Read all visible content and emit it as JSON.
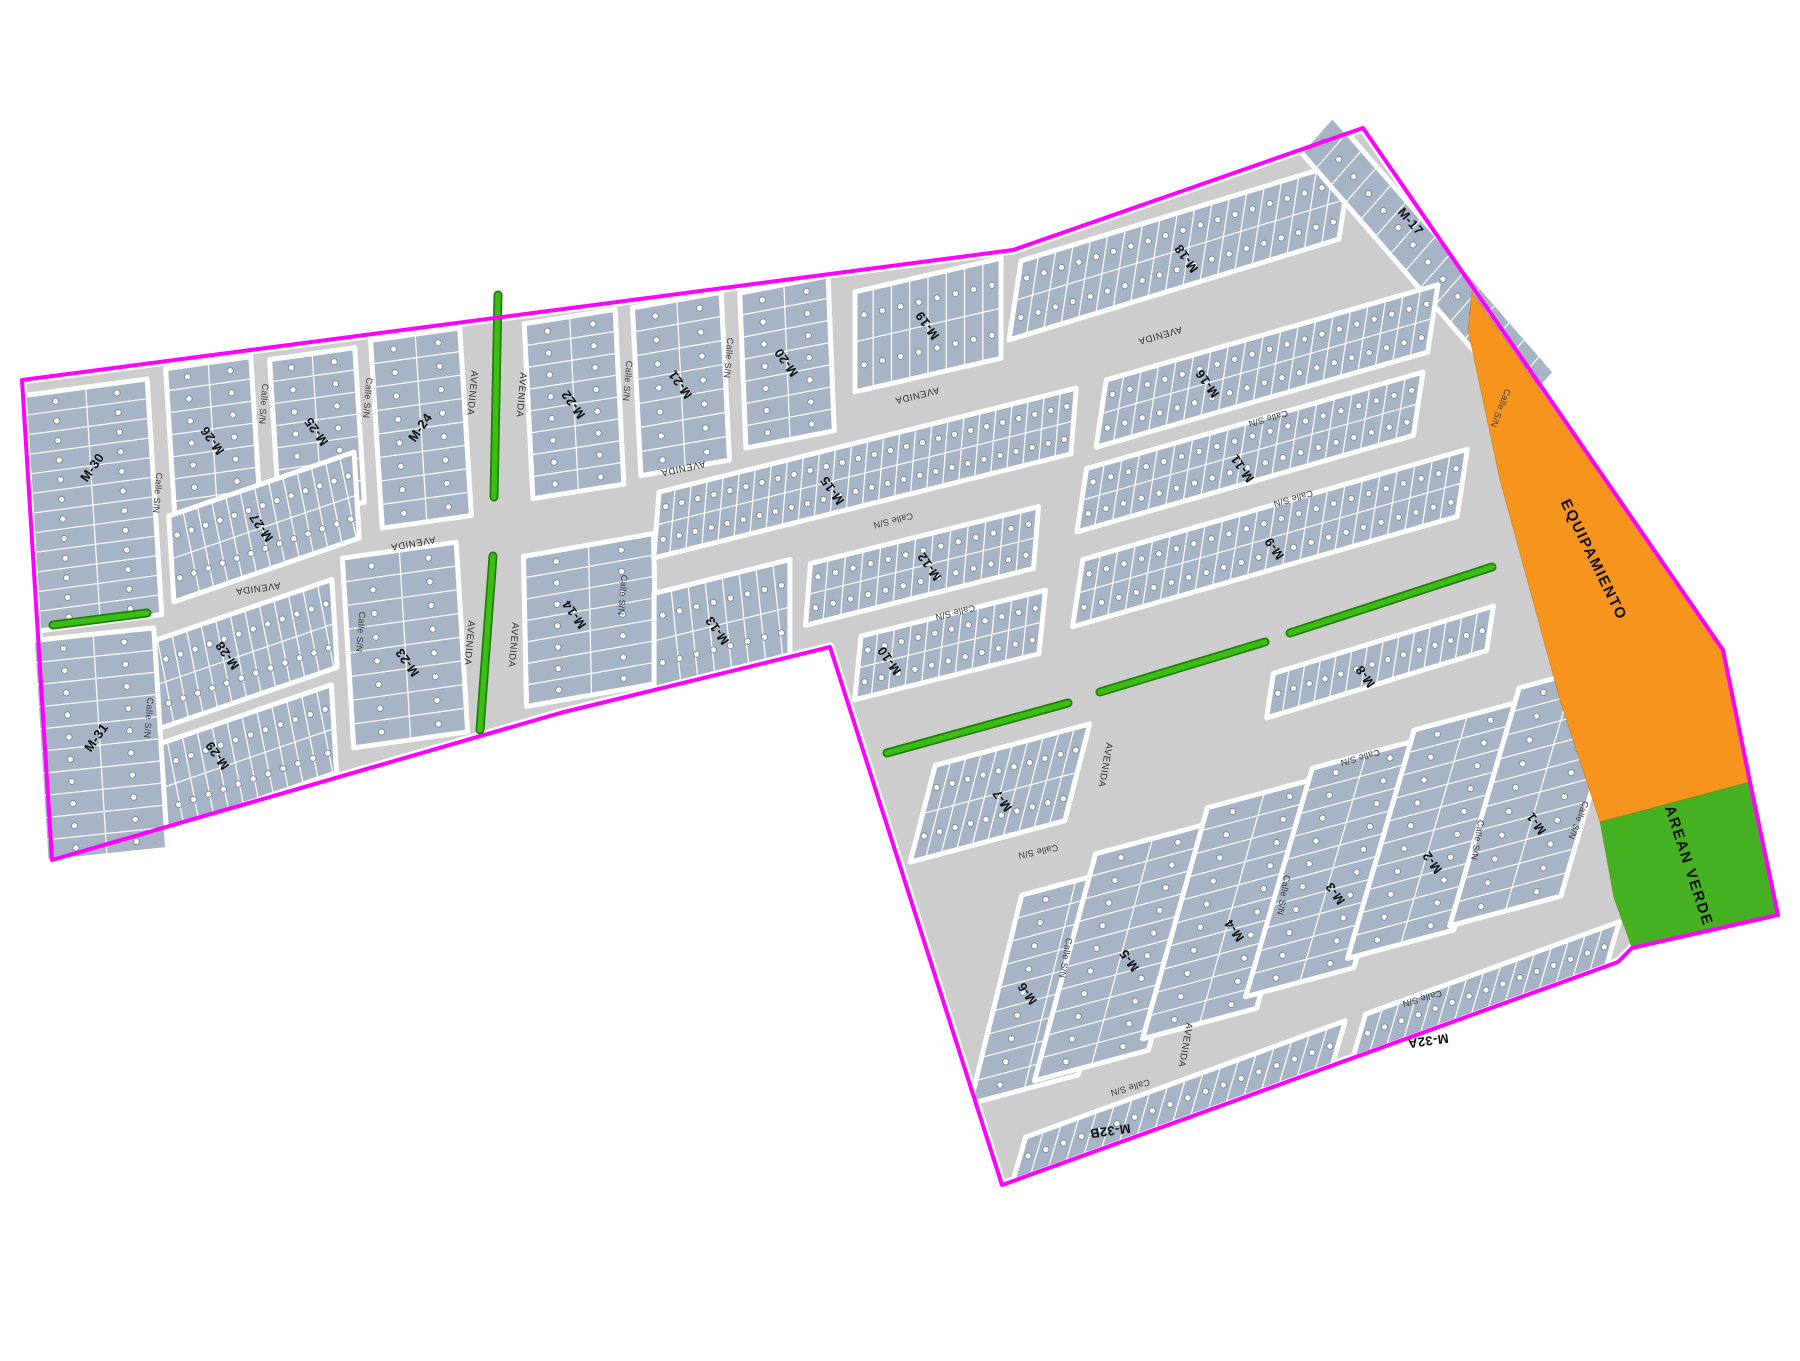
{
  "map": {
    "type": "urban-subdivision-plan",
    "colors": {
      "boundary": "#FF00FF",
      "street": "#CDCDCD",
      "casing": "#FFFFFF",
      "block_fill": "#A6B4C6",
      "lot_line": "#FFFFFF",
      "lot_circle_fill": "#FFFFFF",
      "lot_circle_stroke": "#7E8A96",
      "median_fill": "#3CBD14",
      "median_stroke": "#1F7E0A",
      "equip_fill": "#F7941E",
      "green_fill": "#45B021",
      "block_label": "#111111",
      "street_label": "#3A3A3A"
    },
    "boundary_points": [
      [
        22,
        380
      ],
      [
        1013,
        250
      ],
      [
        1363,
        128
      ],
      [
        1723,
        650
      ],
      [
        1750,
        782
      ],
      [
        1778,
        915
      ],
      [
        1632,
        948
      ],
      [
        1618,
        962
      ],
      [
        1002,
        1185
      ],
      [
        830,
        647
      ],
      [
        560,
        713
      ],
      [
        52,
        860
      ]
    ],
    "zones": [
      {
        "name": "equipamiento",
        "label": "EQUIPAMIENTO",
        "points": [
          [
            1472,
            292
          ],
          [
            1723,
            650
          ],
          [
            1750,
            782
          ],
          [
            1600,
            822
          ],
          [
            1560,
            700
          ],
          [
            1500,
            480
          ],
          [
            1468,
            330
          ]
        ],
        "label_pos": [
          1593,
          560
        ],
        "label_rot": 64,
        "fill": "#F7941E"
      },
      {
        "name": "area-verde",
        "label": "AREAN VERDE",
        "points": [
          [
            1600,
            822
          ],
          [
            1750,
            782
          ],
          [
            1778,
            915
          ],
          [
            1632,
            948
          ],
          [
            1614,
            898
          ]
        ],
        "label_pos": [
          1688,
          866
        ],
        "label_rot": 72,
        "fill": "#45B021"
      }
    ],
    "medians": [
      [
        53,
        625,
        147,
        613
      ],
      [
        498,
        295,
        494,
        497
      ],
      [
        493,
        556,
        480,
        730
      ],
      [
        887,
        753,
        1068,
        703
      ],
      [
        1100,
        692,
        1265,
        642
      ],
      [
        1290,
        633,
        1492,
        567
      ]
    ],
    "blocks": [
      {
        "l": "M-30",
        "cx": 93,
        "cy": 505,
        "w": 124,
        "h": 236,
        "a": -7.7,
        "s": 0.062,
        "gu": 2,
        "gv": 12,
        "sl": 0,
        "lr": -55,
        "lx": 93,
        "ly": 468
      },
      {
        "l": "M-26",
        "cx": 213,
        "cy": 440,
        "w": 86,
        "h": 155,
        "a": -8,
        "s": 0.062,
        "gu": 2,
        "gv": 7,
        "sl": 0,
        "lr": 235
      },
      {
        "l": "M-25",
        "cx": 317,
        "cy": 431,
        "w": 86,
        "h": 155,
        "a": -8,
        "s": 0.062,
        "gu": 2,
        "gv": 7,
        "sl": 0,
        "lr": 235
      },
      {
        "l": "M-24",
        "cx": 421,
        "cy": 428,
        "w": 90,
        "h": 188,
        "a": -8,
        "s": 0.062,
        "gu": 2,
        "gv": 8,
        "sl": 0,
        "lr": -55
      },
      {
        "l": "M-22",
        "cx": 574,
        "cy": 404,
        "w": 92,
        "h": 175,
        "a": -9,
        "s": 0.05,
        "gu": 2,
        "gv": 8,
        "sl": 0,
        "lr": 235
      },
      {
        "l": "M-21",
        "cx": 681,
        "cy": 384,
        "w": 90,
        "h": 168,
        "a": -10,
        "s": 0.05,
        "gu": 2,
        "gv": 7,
        "sl": 0,
        "lr": 235
      },
      {
        "l": "M-20",
        "cx": 787,
        "cy": 362,
        "w": 90,
        "h": 155,
        "a": -11,
        "s": 0.04,
        "gu": 2,
        "gv": 7,
        "sl": 0,
        "lr": 235
      },
      {
        "l": "M-19",
        "cx": 928,
        "cy": 325,
        "w": 150,
        "h": 100,
        "a": -13,
        "s": 0,
        "gu": 8,
        "gv": 2,
        "sl": 0,
        "lr": 235
      },
      {
        "l": "M-27",
        "cx": 264,
        "cy": 527,
        "w": 196,
        "h": 86,
        "a": -19,
        "s": 0.06,
        "gu": 13,
        "gv": 2,
        "sl": 12,
        "lr": 235,
        "lx": 262,
        "ly": 527
      },
      {
        "l": "M-28",
        "cx": 240,
        "cy": 656,
        "w": 200,
        "h": 88,
        "a": -19,
        "s": 0.06,
        "gu": 13,
        "gv": 2,
        "sl": 12,
        "lr": 235,
        "lx": 228,
        "ly": 655
      },
      {
        "l": "M-29",
        "cx": 237,
        "cy": 762,
        "w": 205,
        "h": 88,
        "a": -19,
        "s": 0.06,
        "gu": 13,
        "gv": 2,
        "sl": 12,
        "lr": 235,
        "lx": 218,
        "ly": 755
      },
      {
        "l": "M-31",
        "cx": 100,
        "cy": 745,
        "w": 122,
        "h": 222,
        "a": -6,
        "s": 0.062,
        "gu": 2,
        "gv": 10,
        "sl": 0,
        "lr": -55,
        "lx": 97,
        "ly": 738
      },
      {
        "l": "M-23",
        "cx": 405,
        "cy": 645,
        "w": 115,
        "h": 190,
        "a": -8,
        "s": 0.06,
        "gu": 2,
        "gv": 8,
        "sl": 0,
        "lr": 235,
        "lx": 408,
        "ly": 662
      },
      {
        "l": "M-14",
        "cx": 590,
        "cy": 620,
        "w": 132,
        "h": 150,
        "a": -10,
        "s": 0.02,
        "gu": 2,
        "gv": 7,
        "sl": 0,
        "lr": 235,
        "lx": 575,
        "ly": 614
      },
      {
        "l": "M-13",
        "cx": 722,
        "cy": 624,
        "w": 140,
        "h": 95,
        "a": -14,
        "s": 0,
        "gu": 8,
        "gv": 2,
        "sl": 10,
        "lr": 235,
        "lx": 718,
        "ly": 630
      },
      {
        "l": "M-15",
        "cx": 865,
        "cy": 473,
        "w": 430,
        "h": 66,
        "a": -14,
        "s": -0.08,
        "gu": 26,
        "gv": 2,
        "sl": 0,
        "lr": 235,
        "lx": 833,
        "ly": 490
      },
      {
        "l": "M-12",
        "cx": 922,
        "cy": 566,
        "w": 235,
        "h": 62,
        "a": -14,
        "s": -0.08,
        "gu": 13,
        "gv": 2,
        "sl": 0,
        "lr": 235,
        "lx": 930,
        "ly": 566
      },
      {
        "l": "M-10",
        "cx": 950,
        "cy": 645,
        "w": 190,
        "h": 64,
        "a": -14,
        "s": -0.1,
        "gu": 11,
        "gv": 2,
        "sl": 0,
        "lr": 235,
        "lx": 890,
        "ly": 660
      },
      {
        "l": "M-18",
        "cx": 1180,
        "cy": 250,
        "w": 345,
        "h": 80,
        "a": -17,
        "s": -0.15,
        "gu": 19,
        "gv": 2,
        "sl": 0,
        "lr": 235,
        "lx": 1187,
        "ly": 258
      },
      {
        "l": "M-17",
        "cx": 1428,
        "cy": 262,
        "w": 340,
        "h": 48,
        "a": 49,
        "s": -0.66,
        "gu": 15,
        "gv": 1,
        "sl": 0,
        "lr": 49,
        "lx": 1410,
        "ly": 222
      },
      {
        "l": "M-16",
        "cx": 1267,
        "cy": 366,
        "w": 345,
        "h": 68,
        "a": -16,
        "s": -0.15,
        "gu": 19,
        "gv": 2,
        "sl": 0,
        "lr": 235,
        "lx": 1208,
        "ly": 383
      },
      {
        "l": "M-11",
        "cx": 1250,
        "cy": 452,
        "w": 350,
        "h": 64,
        "a": -16,
        "s": -0.15,
        "gu": 19,
        "gv": 2,
        "sl": 0,
        "lr": 235,
        "lx": 1243,
        "ly": 468
      },
      {
        "l": "M-9",
        "cx": 1270,
        "cy": 538,
        "w": 400,
        "h": 68,
        "a": -16,
        "s": -0.15,
        "gu": 22,
        "gv": 2,
        "sl": 0,
        "lr": 235,
        "lx": 1275,
        "ly": 548
      },
      {
        "l": "M-8",
        "cx": 1380,
        "cy": 662,
        "w": 230,
        "h": 45,
        "a": -17,
        "s": -0.15,
        "gu": 14,
        "gv": 1,
        "sl": 0,
        "lr": 235,
        "lx": 1366,
        "ly": 676
      },
      {
        "l": "M-7",
        "cx": 1000,
        "cy": 793,
        "w": 160,
        "h": 100,
        "a": -15,
        "s": -0.25,
        "gu": 10,
        "gv": 2,
        "sl": 0,
        "lr": 235,
        "lx": 1003,
        "ly": 800
      },
      {
        "l": "M-6",
        "cx": 1050,
        "cy": 985,
        "w": 112,
        "h": 215,
        "a": -15,
        "s": -0.24,
        "gu": 2,
        "gv": 9,
        "sl": 0,
        "lr": 235,
        "lx": 1028,
        "ly": 993
      },
      {
        "l": "M-5",
        "cx": 1122,
        "cy": 952,
        "w": 118,
        "h": 235,
        "a": -15,
        "s": -0.26,
        "gu": 2,
        "gv": 10,
        "sl": 0,
        "lr": 235,
        "lx": 1130,
        "ly": 960
      },
      {
        "l": "M-4",
        "cx": 1232,
        "cy": 908,
        "w": 118,
        "h": 240,
        "a": -15,
        "s": -0.27,
        "gu": 2,
        "gv": 10,
        "sl": 0,
        "lr": 235,
        "lx": 1235,
        "ly": 930
      },
      {
        "l": "M-3",
        "cx": 1333,
        "cy": 868,
        "w": 112,
        "h": 238,
        "a": -15,
        "s": -0.28,
        "gu": 2,
        "gv": 10,
        "sl": 0,
        "lr": 235,
        "lx": 1336,
        "ly": 893
      },
      {
        "l": "M-2",
        "cx": 1434,
        "cy": 830,
        "w": 110,
        "h": 238,
        "a": -15,
        "s": -0.28,
        "gu": 2,
        "gv": 10,
        "sl": 0,
        "lr": 235,
        "lx": 1433,
        "ly": 862
      },
      {
        "l": "M-1",
        "cx": 1540,
        "cy": 792,
        "w": 115,
        "h": 248,
        "a": -15,
        "s": -0.28,
        "gu": 2,
        "gv": 10,
        "sl": 0,
        "lr": 235,
        "lx": 1537,
        "ly": 823
      },
      {
        "l": "M-32A",
        "cx": 1486,
        "cy": 990,
        "w": 270,
        "h": 46,
        "a": -20,
        "s": -0.28,
        "gu": 15,
        "gv": 1,
        "sl": 0,
        "lr": 172,
        "lx": 1428,
        "ly": 1040
      },
      {
        "l": "M-32B",
        "cx": 1179,
        "cy": 1101,
        "w": 340,
        "h": 46,
        "a": -20,
        "s": -0.28,
        "gu": 18,
        "gv": 1,
        "sl": 0,
        "lr": 172,
        "lx": 1110,
        "ly": 1130
      }
    ],
    "street_labels": [
      {
        "t": "Calle S/N",
        "x": 157,
        "y": 493,
        "r": 95
      },
      {
        "t": "Calle S/N",
        "x": 263,
        "y": 404,
        "r": 95
      },
      {
        "t": "Calle S/N",
        "x": 367,
        "y": 398,
        "r": 95
      },
      {
        "t": "Calle S/N",
        "x": 627,
        "y": 381,
        "r": 95
      },
      {
        "t": "Calle S/N",
        "x": 728,
        "y": 358,
        "r": 95
      },
      {
        "t": "Calle S/N",
        "x": 622,
        "y": 595,
        "r": 95
      },
      {
        "t": "Calle S/N",
        "x": 148,
        "y": 718,
        "r": 95
      },
      {
        "t": "Calle S/N",
        "x": 360,
        "y": 632,
        "r": 95
      },
      {
        "t": "Calle S/N",
        "x": 893,
        "y": 520,
        "r": 166
      },
      {
        "t": "Calle S/N",
        "x": 955,
        "y": 612,
        "r": 166
      },
      {
        "t": "Calle S/N",
        "x": 1268,
        "y": 418,
        "r": 164
      },
      {
        "t": "Calle S/N",
        "x": 1293,
        "y": 498,
        "r": 164
      },
      {
        "t": "Calle S/N",
        "x": 1360,
        "y": 757,
        "r": 164
      },
      {
        "t": "Calle S/N",
        "x": 1500,
        "y": 408,
        "r": 112
      },
      {
        "t": "Calle S/N",
        "x": 1578,
        "y": 820,
        "r": 112
      },
      {
        "t": "Calle S/N",
        "x": 1038,
        "y": 851,
        "r": 168
      },
      {
        "t": "Calle S/N",
        "x": 1065,
        "y": 958,
        "r": 100
      },
      {
        "t": "Calle S/N",
        "x": 1130,
        "y": 1087,
        "r": 164
      },
      {
        "t": "Calle S/N",
        "x": 1283,
        "y": 895,
        "r": 100
      },
      {
        "t": "Calle S/N",
        "x": 1422,
        "y": 998,
        "r": 164
      },
      {
        "t": "Calle S/N",
        "x": 1477,
        "y": 840,
        "r": 100
      },
      {
        "t": "AVENIDA",
        "x": 258,
        "y": 588,
        "r": 172,
        "av": true
      },
      {
        "t": "AVENIDA",
        "x": 413,
        "y": 543,
        "r": 170,
        "av": true
      },
      {
        "t": "AVENIDA",
        "x": 683,
        "y": 468,
        "r": 168,
        "av": true
      },
      {
        "t": "AVENIDA",
        "x": 917,
        "y": 395,
        "r": 166,
        "av": true
      },
      {
        "t": "AVENIDA",
        "x": 1160,
        "y": 335,
        "r": 164,
        "av": true
      },
      {
        "t": "AVENIDA",
        "x": 472,
        "y": 393,
        "r": 95,
        "av": true
      },
      {
        "t": "AVENIDA",
        "x": 521,
        "y": 395,
        "r": 95,
        "av": true
      },
      {
        "t": "AVENIDA",
        "x": 469,
        "y": 643,
        "r": 95,
        "av": true
      },
      {
        "t": "AVENIDA",
        "x": 513,
        "y": 645,
        "r": 95,
        "av": true
      },
      {
        "t": "AVENIDA",
        "x": 1105,
        "y": 765,
        "r": 100,
        "av": true
      },
      {
        "t": "AVENIDA",
        "x": 1185,
        "y": 1045,
        "r": 100,
        "av": true
      }
    ]
  }
}
